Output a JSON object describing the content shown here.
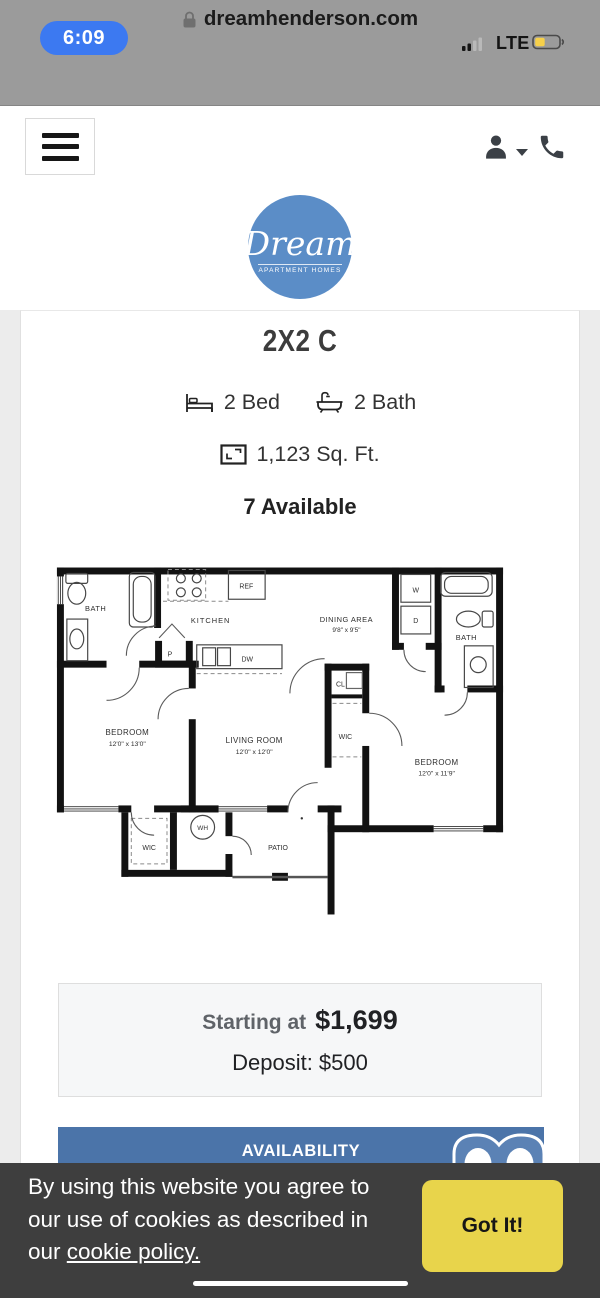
{
  "colors": {
    "status_bar_bg": "#9b9b9b",
    "time_pill_blue": "#3c79f1",
    "battery_yellow": "#f6d04a",
    "logo_blue": "#5b8dc7",
    "availability_blue": "#4b74a9",
    "cookie_banner_bg": "#3e3e3e",
    "cookie_button_yellow": "#e8d44b"
  },
  "status_bar": {
    "time": "6:09",
    "network": "LTE"
  },
  "url_bar": {
    "domain": "dreamhenderson.com"
  },
  "logo": {
    "name": "Dream",
    "subtitle": "APARTMENT HOMES"
  },
  "listing": {
    "title": "2X2 C",
    "beds": "2 Bed",
    "baths": "2 Bath",
    "sqft": "1,123 Sq. Ft.",
    "available": "7 Available"
  },
  "pricing": {
    "starting_label": "Starting at",
    "price": "$1,699",
    "deposit": "Deposit: $500"
  },
  "availability": {
    "header": "AVAILABILITY"
  },
  "floor_plan": {
    "bath1": "BATH",
    "kitchen": "KITCHEN",
    "dining_name": "DINING AREA",
    "dining_dims": "9'8\" x 9'5\"",
    "ref": "REF",
    "washer": "W",
    "dryer": "D",
    "dishwasher": "DW",
    "pantry": "P",
    "closet": "CL",
    "bath2": "BATH",
    "bedroom1_name": "BEDROOM",
    "bedroom1_dims": "12'0\" x 13'0\"",
    "living_name": "LIVING ROOM",
    "living_dims": "12'0\" x 12'0\"",
    "wic1": "WIC",
    "wic2": "WIC",
    "water_heater": "WH",
    "bedroom2_name": "BEDROOM",
    "bedroom2_dims": "12'0\" x 11'9\"",
    "patio": "PATIO"
  },
  "cookie_banner": {
    "line1": "By using this website you agree to",
    "line2": "our use of cookies as described in",
    "line3_prefix": "our ",
    "link_text": "cookie policy.",
    "button_label": "Got It!"
  }
}
